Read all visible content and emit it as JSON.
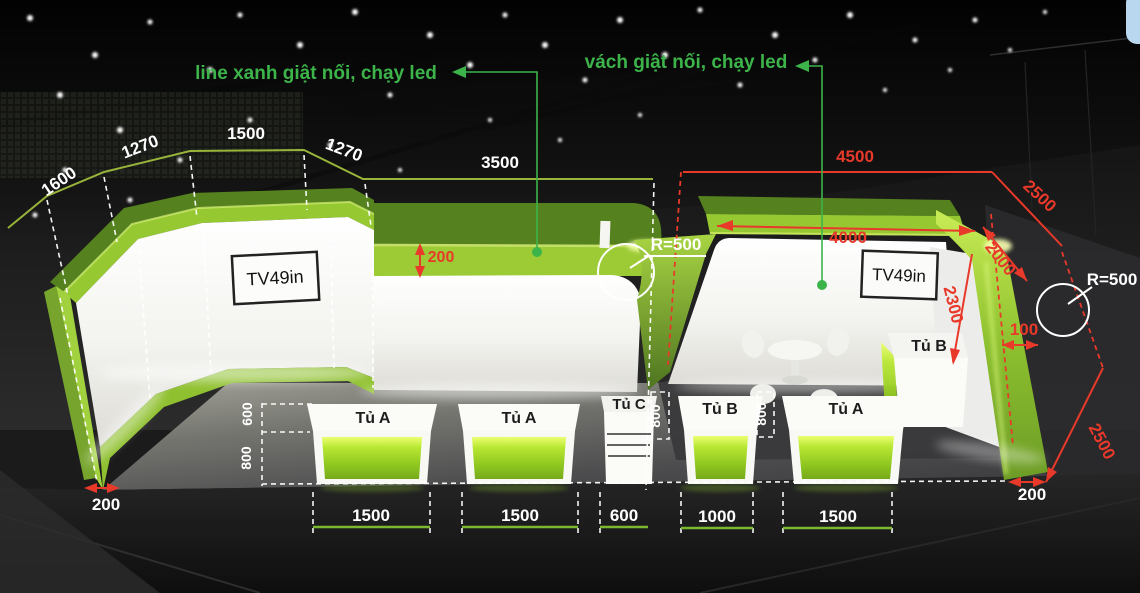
{
  "annotations": {
    "line_led": "line xanh giật nối, chạy led",
    "wall_led": "vách giật nối, chạy led"
  },
  "dims": {
    "seg1600": "1600",
    "seg1270a": "1270",
    "seg1500": "1500",
    "seg1270b": "1270",
    "wall3500": "3500",
    "band200": "200",
    "radius_left": "R=500",
    "radius_right": "R=500",
    "top4500": "4500",
    "diag2500": "2500",
    "back4000": "4000",
    "corner2000": "2000",
    "height2300": "2300",
    "gap100": "100",
    "side2500": "2500",
    "base200_left": "200",
    "base200_right": "200",
    "cab_depth600": "600",
    "cab_height800": "800",
    "cab_height800_c": "800",
    "cab_height800_b": "800",
    "w_a1": "1500",
    "w_a2": "1500",
    "w_c": "600",
    "w_b1": "1000",
    "w_a3": "1500"
  },
  "screens": {
    "tv_left": "TV49in",
    "tv_right": "TV49in"
  },
  "cabinets": {
    "a1": "Tủ A",
    "a2": "Tủ A",
    "c": "Tủ C",
    "b1": "Tủ B",
    "a3": "Tủ A",
    "b_side": "Tủ B"
  },
  "colors": {
    "accent_green": "#8dc63f",
    "annotation_green": "#3cb44a",
    "dimension_red": "#e8392a"
  }
}
